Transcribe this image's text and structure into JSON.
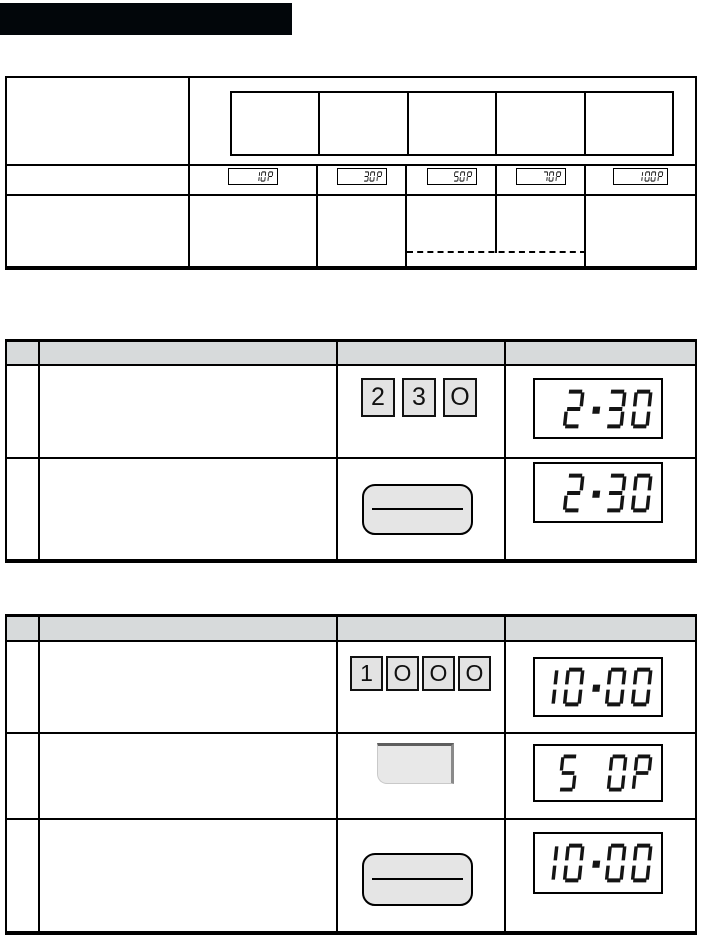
{
  "power_table": {
    "displays": [
      "10P",
      "30P",
      "50P",
      "70P",
      "100P"
    ]
  },
  "time_cook_example": {
    "steps": [
      {
        "keys": [
          "2",
          "3",
          "O"
        ],
        "display": "2.30"
      },
      {
        "display": "2.30"
      }
    ]
  },
  "power_cook_example": {
    "steps": [
      {
        "keys": [
          "1",
          "O",
          "O",
          "O"
        ],
        "display": "10.00"
      },
      {
        "display": "5 0P"
      },
      {
        "display": "10.00"
      }
    ]
  }
}
